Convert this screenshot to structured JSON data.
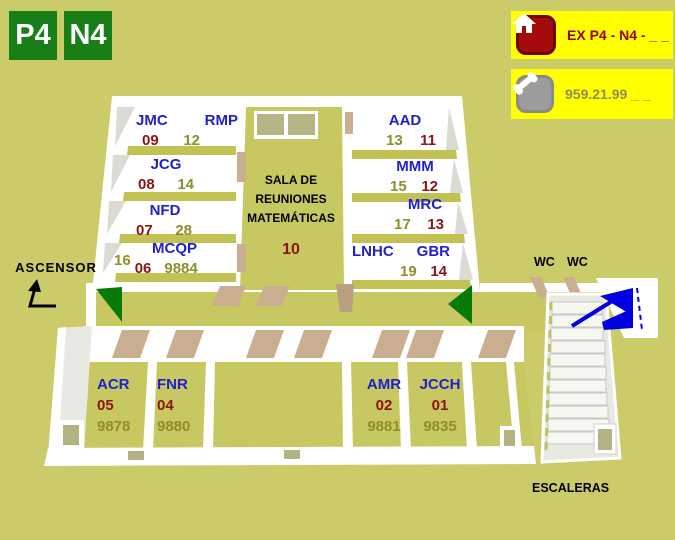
{
  "colors": {
    "background": "#cbcb6a",
    "floor_badge_green": "#187f18",
    "info_box_yellow": "#ffff00",
    "room_name_blue": "#2020cf",
    "room_number_red": "#8e1313",
    "extension_olive": "#8e8e2b",
    "door_tan": "#c9ae8f",
    "door_swing_green": "#077b07",
    "stairs_arrow_blue": "#0000e0"
  },
  "floor_badges": [
    "P4",
    "N4"
  ],
  "header": {
    "extension_box": {
      "icon": "home-icon",
      "text": "EX P4 - N4 - _ _"
    },
    "phone_box": {
      "icon": "phone-icon",
      "text": "959.21.99 _ _"
    }
  },
  "map_labels": {
    "elevator": "ASCENSOR",
    "wc_left": "WC",
    "wc_right": "WC",
    "stairs": "ESCALERAS"
  },
  "meeting_room": {
    "line1": "SALA DE",
    "line2": "REUNIONES",
    "line3": "MATEMÁTICAS",
    "number": "10"
  },
  "offices": {
    "jmc_rmp": {
      "name_a": "JMC",
      "name_b": "RMP",
      "num_red": "09",
      "num_olive": "12"
    },
    "jcg": {
      "name": "JCG",
      "num_red": "08",
      "num_olive": "14"
    },
    "nfd": {
      "name": "NFD",
      "num_red": "07",
      "num_olive": "28"
    },
    "mcqp": {
      "name": "MCQP",
      "num_pre": "16",
      "num_red": "06",
      "num_ext": "9884"
    },
    "aad": {
      "name": "AAD",
      "num_olive": "13",
      "num_red": "11"
    },
    "mmm": {
      "name": "MMM",
      "num_olive": "15",
      "num_red": "12"
    },
    "mrc": {
      "name": "MRC",
      "num_olive": "17",
      "num_red": "13"
    },
    "lnhc_gbr": {
      "name_a": "LNHC",
      "name_b": "GBR",
      "num_olive": "19",
      "num_red": "14"
    },
    "acr": {
      "name": "ACR",
      "num_red": "05",
      "num_ext": "9878"
    },
    "fnr": {
      "name": "FNR",
      "num_red": "04",
      "num_ext": "9880"
    },
    "amr": {
      "name": "AMR",
      "num_red": "02",
      "num_ext": "9881"
    },
    "jcch": {
      "name": "JCCH",
      "num_red": "01",
      "num_ext": "9835"
    }
  }
}
